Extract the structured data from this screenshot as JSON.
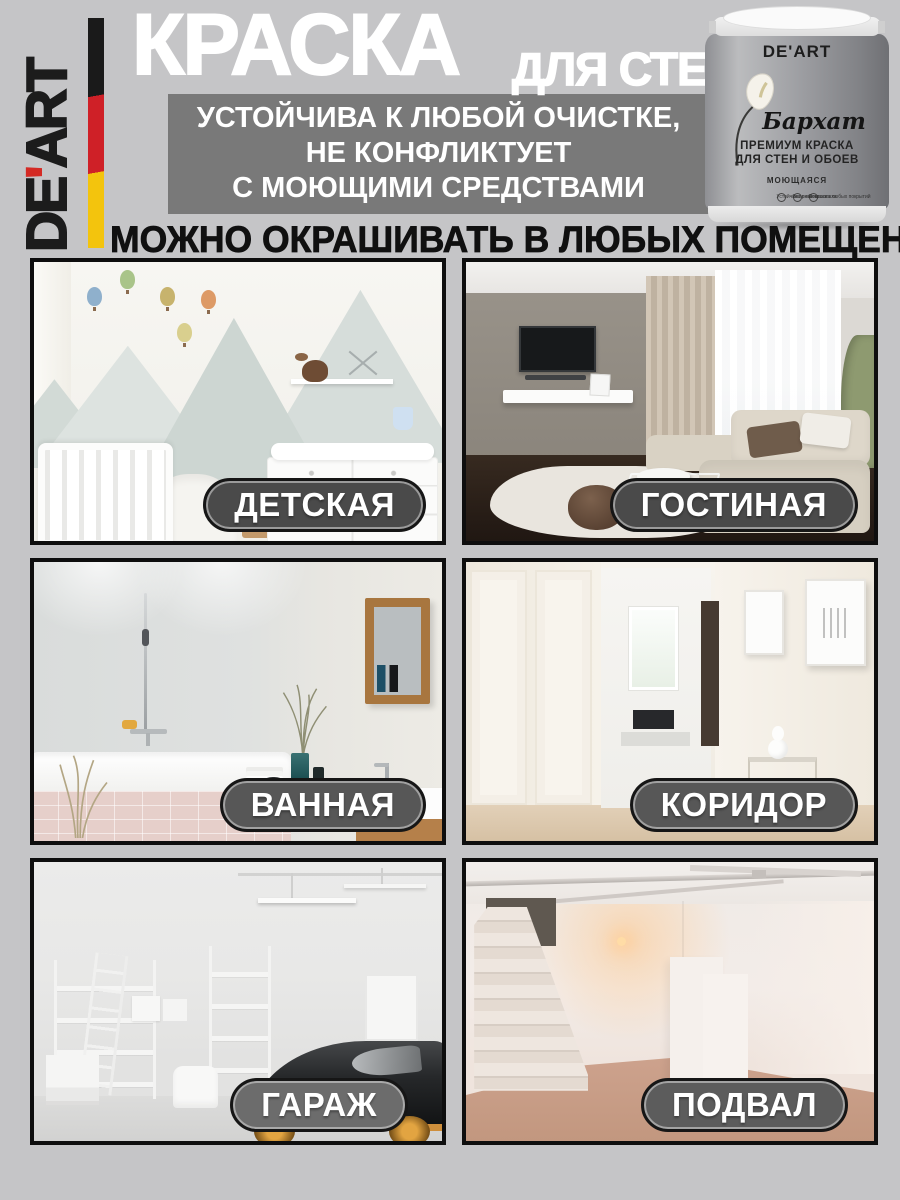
{
  "page": {
    "background": "#c5c5c7"
  },
  "brand": {
    "name_first": "DE",
    "apostrophe": "'",
    "name_rest": "ART",
    "apostrophe_color": "#d42a24",
    "flag_colors": [
      "#1a1a1a",
      "#cf2027",
      "#f3c40d"
    ]
  },
  "header": {
    "title": "КРАСКА",
    "subtitle": "ДЛЯ СТЕН",
    "badge": {
      "background": "#797979",
      "lines": [
        "УСТОЙЧИВА К ЛЮБОЙ ОЧИСТКЕ,",
        "НЕ КОНФЛИКТУЕТ",
        "С МОЮЩИМИ СРЕДСТВАМИ"
      ]
    },
    "tagline": "МОЖНО ОКРАШИВАТЬ В ЛЮБЫХ ПОМЕЩЕНИЯХ"
  },
  "product_can": {
    "brand": "DE'ART",
    "series": "Бархат",
    "type_line1": "ПРЕМИУМ КРАСКА",
    "type_line2": "ДЛЯ СТЕН И ОБОЕВ",
    "property": "МОЮЩАЯСЯ",
    "features": [
      "Устойчива к мытью",
      "Без резкого запаха",
      "Покраска любых покрытий"
    ]
  },
  "rooms": [
    {
      "id": "nursery",
      "label": "ДЕТСКАЯ"
    },
    {
      "id": "living-room",
      "label": "ГОСТИНАЯ"
    },
    {
      "id": "bathroom",
      "label": "ВАННАЯ"
    },
    {
      "id": "corridor",
      "label": "КОРИДОР"
    },
    {
      "id": "garage",
      "label": "ГАРАЖ"
    },
    {
      "id": "basement",
      "label": "ПОДВАЛ"
    }
  ],
  "label_pill": {
    "text_color": "#ffffff",
    "background": "#4a4a4a",
    "border": "#161616"
  }
}
